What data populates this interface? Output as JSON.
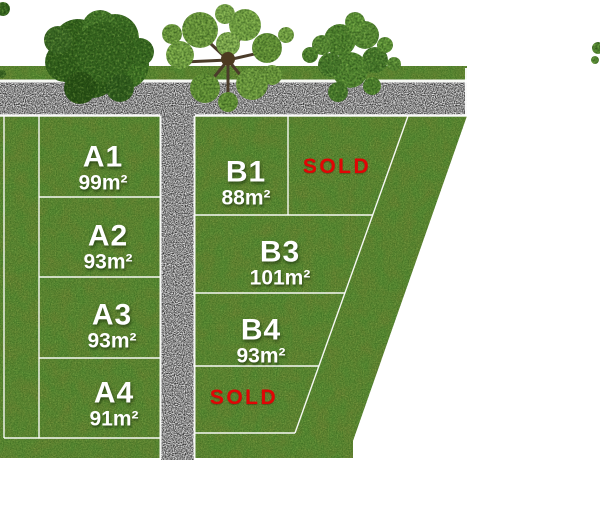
{
  "plan_type": "land-subdivision-site-plan",
  "lots": [
    {
      "id": "A1",
      "area": "99m²",
      "status": "available"
    },
    {
      "id": "A2",
      "area": "93m²",
      "status": "available"
    },
    {
      "id": "A3",
      "area": "93m²",
      "status": "available"
    },
    {
      "id": "A4",
      "area": "91m²",
      "status": "available"
    },
    {
      "id": "B1",
      "area": "88m²",
      "status": "available"
    },
    {
      "id": "B3",
      "area": "101m²",
      "status": "available"
    },
    {
      "id": "B4",
      "area": "93m²",
      "status": "available"
    }
  ],
  "sold_labels": [
    {
      "text": "SOLD",
      "location": "top-right-lot"
    },
    {
      "text": "SOLD",
      "location": "bottom-middle-lot"
    }
  ],
  "colors": {
    "grass": "#67973c",
    "road_gravel": "#a0a0a0",
    "lot_line": "#ffffff",
    "sold_text": "#e10505",
    "lot_text": "#ffffff",
    "tree_dark_foliage": "#3a6b22",
    "tree_light_foliage": "#7fae4b",
    "background": "#ffffff"
  }
}
